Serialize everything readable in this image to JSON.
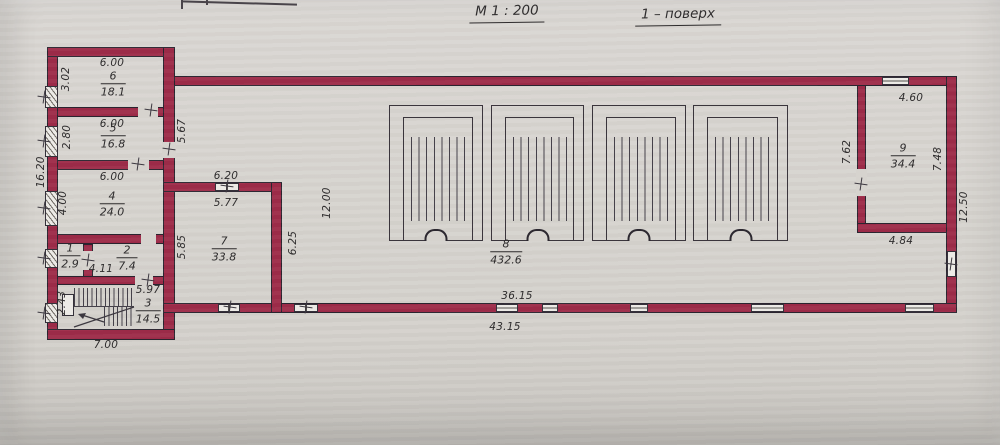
{
  "titles": {
    "scale": "М 1 : 200",
    "floor": "1 – поверх"
  },
  "rooms": {
    "r1": {
      "number": "1",
      "area": "2.9"
    },
    "r2": {
      "number": "2",
      "area": "7.4"
    },
    "r3": {
      "number": "3",
      "area": "14.5"
    },
    "r4": {
      "number": "4",
      "area": "24.0"
    },
    "r5": {
      "number": "5",
      "area": "16.8"
    },
    "r6": {
      "number": "6",
      "area": "18.1"
    },
    "r7": {
      "number": "7",
      "area": "33.8"
    },
    "r8": {
      "number": "8",
      "area": "432.6"
    },
    "r9": {
      "number": "9",
      "area": "34.4"
    }
  },
  "dimensions": {
    "r6_w": "6.00",
    "r6_h": "3.02",
    "r5_w": "6.00",
    "r5_h": "2.80",
    "r4_w": "6.00",
    "r4_h": "4.00",
    "left_total_h": "16.20",
    "corridor_h": "5.67",
    "vestibule_w": "4.11",
    "stair_w": "5.97",
    "stair_h": "2.43",
    "block_w": "7.00",
    "r7_w_out": "6.20",
    "r7_w_in": "5.77",
    "r7_h": "5.85",
    "r7_h_out": "6.25",
    "hall_h": "12.00",
    "hall_w_in": "36.15",
    "total_w": "43.15",
    "r9_w": "4.60",
    "r9_h_left": "7.62",
    "r9_h_right": "7.48",
    "r9_w_bottom": "4.84",
    "right_total_h": "12.50"
  }
}
